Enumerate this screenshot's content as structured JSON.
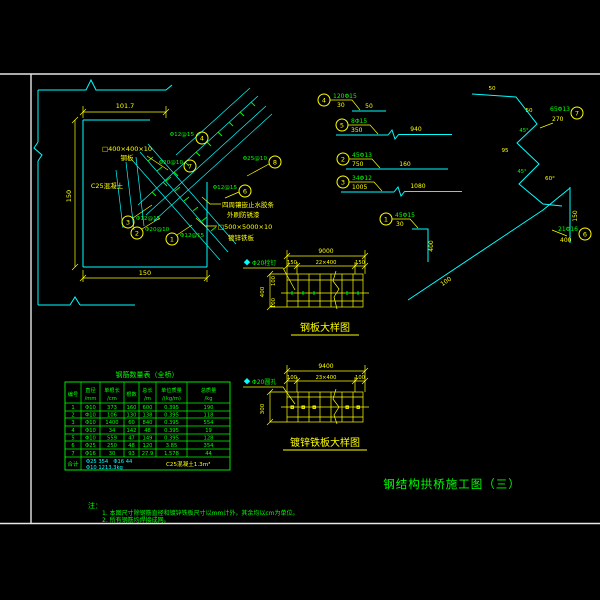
{
  "colors": {
    "background": "#000000",
    "line_cyan": "#00ffff",
    "dim_yellow": "#ffff00",
    "text_green": "#00ff00",
    "frame_white": "#e6e6e6"
  },
  "sheet_title": "钢结构拱桥施工图（三）",
  "anchor_detail": {
    "dims": {
      "top": "101.7",
      "left": "150",
      "bottom": "150"
    },
    "labels": {
      "plate": "□400×400×10",
      "plate2": "钢板",
      "concrete": "C25混凝土",
      "seal1": "四周镶嵌止水胶条",
      "seal2": "外刷防锈漆",
      "gplate": "□500×5000×10",
      "gplate2": "镀锌铁板"
    },
    "callouts": [
      {
        "mark": "4",
        "label": "Φ12@15"
      },
      {
        "mark": "8",
        "label": "Φ25@10"
      },
      {
        "mark": "7",
        "label": "Φ20@10"
      },
      {
        "mark": "6",
        "label": "Φ12@15"
      },
      {
        "mark": "3",
        "label": "Φ12@15"
      },
      {
        "mark": "2",
        "label": "Φ20@10"
      },
      {
        "mark": "1",
        "label": "Φ12@15"
      }
    ]
  },
  "right_shapes": {
    "items": [
      {
        "mark": "4",
        "spec": "120Φ15",
        "dim": "30",
        "len": "50"
      },
      {
        "mark": "5",
        "spec": "8Φ15",
        "dim": "350",
        "len": "940"
      },
      {
        "mark": "2",
        "spec": "45Φ13",
        "dim": "750",
        "len": "160"
      },
      {
        "mark": "3",
        "spec": "34Φ12",
        "dim": "1005",
        "len": "1080"
      },
      {
        "mark": "1",
        "spec": "45Φ15",
        "dim": "30",
        "len": "400"
      },
      {
        "mark": "7",
        "spec": "65Φ13",
        "dim": "270",
        "len": ""
      },
      {
        "mark": "6",
        "spec": "21Φ16",
        "dim": "400",
        "len": ""
      }
    ],
    "zigzag_dims": [
      "50",
      "50",
      "95",
      "60°"
    ],
    "zigzag_angles": [
      "45°",
      "45°"
    ],
    "diag_dim": "100",
    "vert_dim": "150"
  },
  "plate_detail": {
    "title": "钢板大样图",
    "dim_top": "9000",
    "dim_l": "150",
    "dim_c": "22×400",
    "dim_r": "150",
    "dim_left": "400",
    "dim_left_a": "100",
    "dim_left_b": "100",
    "stud": "Φ20栓钉"
  },
  "zinc_detail": {
    "title": "镀锌铁板大样图",
    "dim_top": "9400",
    "dim_l": "100",
    "dim_c": "23×400",
    "dim_r": "100",
    "dim_left": "300",
    "stud": "Φ20圆孔"
  },
  "rebar_table": {
    "title": "钢筋数量表（全桥）",
    "headers_l1": [
      "编号",
      "直径",
      "单根长",
      "根数",
      "总长",
      "单位质量",
      "总质量"
    ],
    "headers_l2": [
      "",
      "/mm",
      "/cm",
      "",
      "/m",
      "/(kg/m)",
      "/kg"
    ],
    "rows": [
      [
        "1",
        "Φ10",
        "373",
        "160",
        "600",
        "0.395",
        "190"
      ],
      [
        "2",
        "Φ10",
        "106",
        "130",
        "138",
        "0.395",
        "118"
      ],
      [
        "3",
        "Φ10",
        "1400",
        "60",
        "840",
        "0.395",
        "554"
      ],
      [
        "4",
        "Φ10",
        "34",
        "142",
        "48",
        "0.395",
        "19"
      ],
      [
        "5",
        "Φ10",
        "559",
        "47",
        "149",
        "0.395",
        "128"
      ],
      [
        "6",
        "Φ25",
        "250",
        "48",
        "120",
        "3.85",
        "354"
      ],
      [
        "7",
        "Φ16",
        "30",
        "93",
        "27.9",
        "1.578",
        "44"
      ]
    ],
    "total_label": "合计",
    "total_line1": "Φ25 354　Φ16 44",
    "total_line2": "Φ10 1213.3kg",
    "total_note": "C25混凝土1.3m³"
  },
  "notes": {
    "head": "注：",
    "items": [
      "1. 本图尺寸除钢筋直径和镀锌铁板尺寸以mm计外，其余均以cm为单位。",
      "2. 所有钢筋均焊接成网。"
    ]
  }
}
